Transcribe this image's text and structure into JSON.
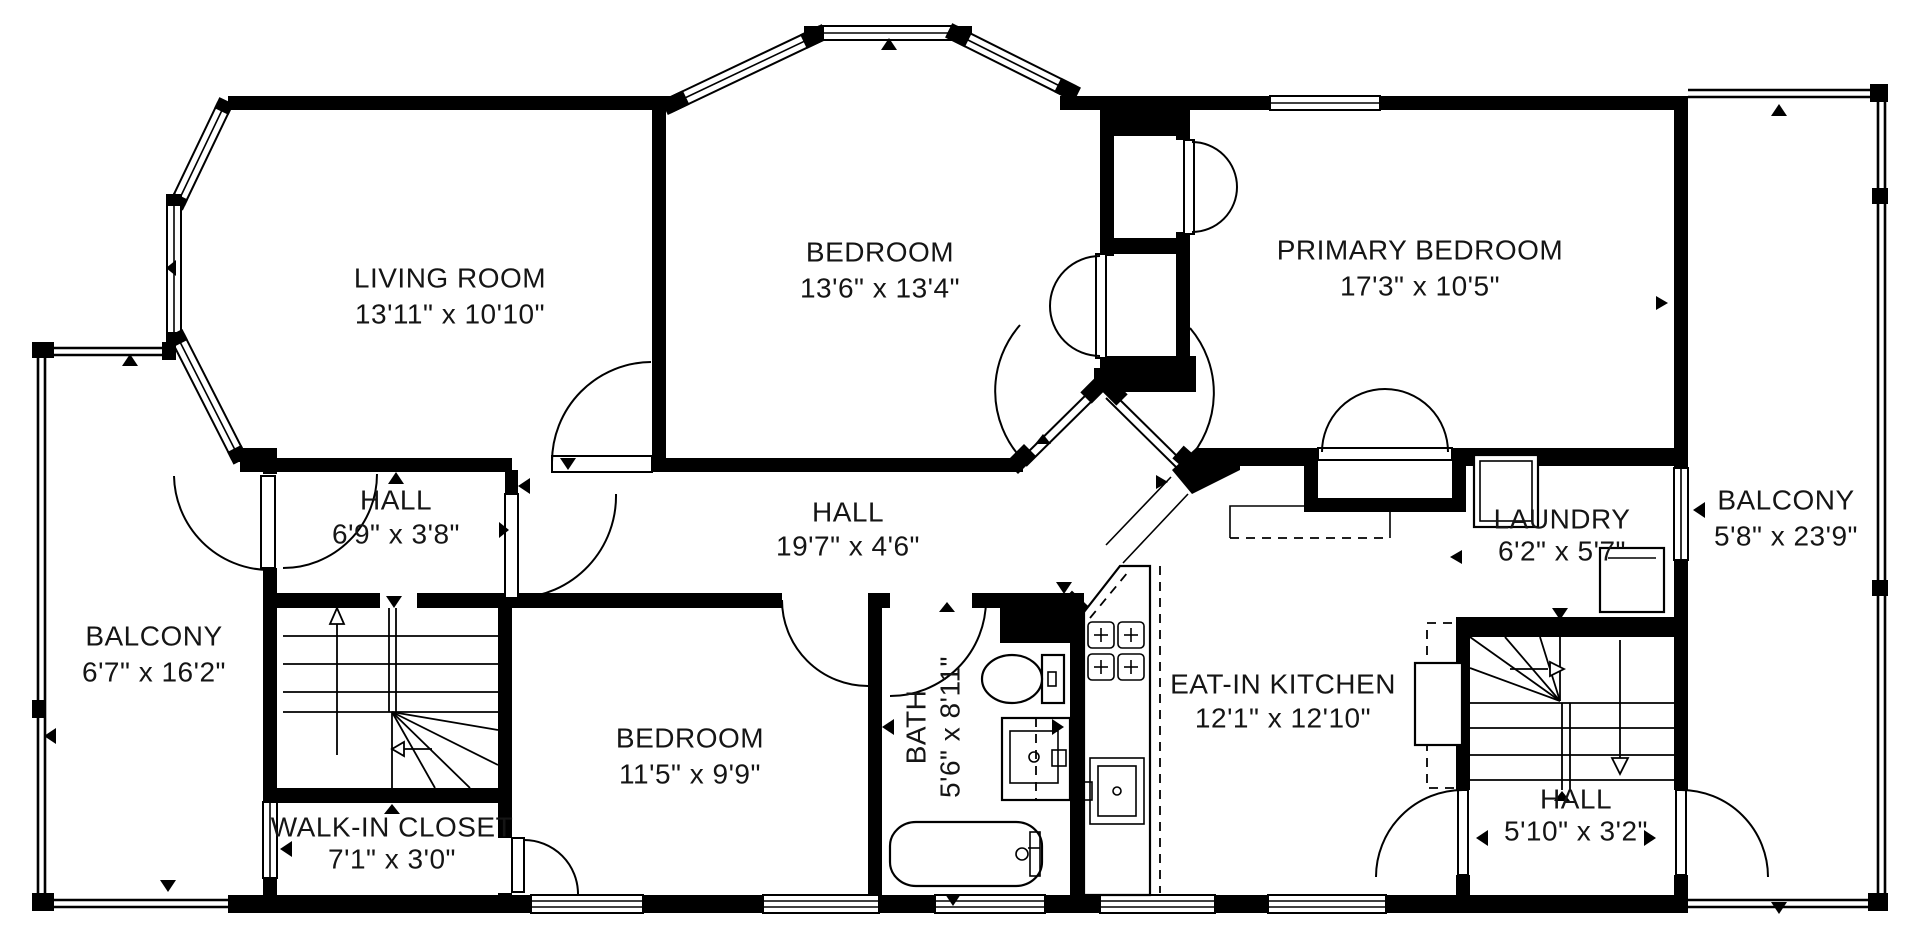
{
  "plan_title": "Floor Plan",
  "colors": {
    "background": "#ffffff",
    "walls": "#000000",
    "text": "#151515"
  },
  "rooms": [
    {
      "id": "living-room",
      "name": "LIVING ROOM",
      "dims": "13'11\" x 10'10\""
    },
    {
      "id": "bedroom-top",
      "name": "BEDROOM",
      "dims": "13'6\" x 13'4\""
    },
    {
      "id": "primary-bedroom",
      "name": "PRIMARY BEDROOM",
      "dims": "17'3\" x 10'5\""
    },
    {
      "id": "hall-small",
      "name": "HALL",
      "dims": "6'9\" x 3'8\""
    },
    {
      "id": "hall-long",
      "name": "HALL",
      "dims": "19'7\" x 4'6\""
    },
    {
      "id": "laundry",
      "name": "LAUNDRY",
      "dims": "6'2\" x 5'7\""
    },
    {
      "id": "balcony-right",
      "name": "BALCONY",
      "dims": "5'8\" x 23'9\""
    },
    {
      "id": "balcony-left",
      "name": "BALCONY",
      "dims": "6'7\" x 16'2\""
    },
    {
      "id": "bedroom-bottom",
      "name": "BEDROOM",
      "dims": "11'5\" x 9'9\""
    },
    {
      "id": "bath",
      "name": "BATH",
      "dims": "5'6\" x 8'11\""
    },
    {
      "id": "eat-in-kitchen",
      "name": "EAT-IN KITCHEN",
      "dims": "12'1\" x 12'10\""
    },
    {
      "id": "walk-in-closet",
      "name": "WALK-IN CLOSET",
      "dims": "7'1\" x 3'0\""
    },
    {
      "id": "hall-bottom",
      "name": "HALL",
      "dims": "5'10\" x 3'2\""
    }
  ]
}
